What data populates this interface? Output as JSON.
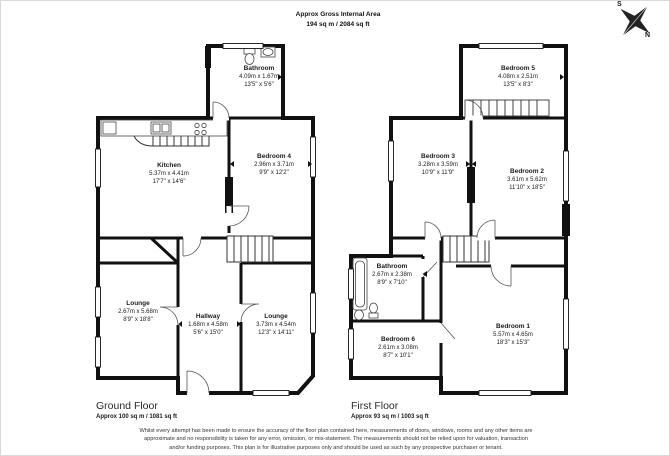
{
  "header": {
    "title": "Approx Gross Internal Area",
    "area": "194 sq m / 2084 sq ft"
  },
  "compass": {
    "north": "N",
    "south": "S"
  },
  "ground_floor": {
    "title": "Ground Floor",
    "area": "Approx 100 sq m / 1081 sq ft",
    "rooms": [
      {
        "name": "Bathroom",
        "metric": "4.09m x 1.67m",
        "imperial": "13'5\" x 5'6\""
      },
      {
        "name": "Kitchen",
        "metric": "5.37m x 4.41m",
        "imperial": "17'7\" x 14'6\""
      },
      {
        "name": "Bedroom 4",
        "metric": "2.96m x 3.71m",
        "imperial": "9'9\" x 12'2\""
      },
      {
        "name": "Lounge",
        "metric": "2.67m x 5.68m",
        "imperial": "8'9\" x 18'8\""
      },
      {
        "name": "Hallway",
        "metric": "1.68m x 4.58m",
        "imperial": "5'6\" x 15'0\""
      },
      {
        "name": "Lounge",
        "metric": "3.73m x 4.54m",
        "imperial": "12'3\" x 14'11\""
      }
    ]
  },
  "first_floor": {
    "title": "First Floor",
    "area": "Approx 93 sq m / 1003 sq ft",
    "rooms": [
      {
        "name": "Bedroom 5",
        "metric": "4.08m x 2.51m",
        "imperial": "13'5\" x 8'3\""
      },
      {
        "name": "Bedroom 3",
        "metric": "3.28m x 3.59m",
        "imperial": "10'9\" x 11'9\""
      },
      {
        "name": "Bedroom 2",
        "metric": "3.61m x 5.62m",
        "imperial": "11'10\" x 18'5\""
      },
      {
        "name": "Bathroom",
        "metric": "2.67m x 2.38m",
        "imperial": "8'9\" x 7'10\""
      },
      {
        "name": "Bedroom 6",
        "metric": "2.61m x 3.08m",
        "imperial": "8'7\" x 10'1\""
      },
      {
        "name": "Bedroom 1",
        "metric": "5.57m x 4.65m",
        "imperial": "18'3\" x 15'3\""
      }
    ]
  },
  "disclaimer": "Whilst every attempt has been made to ensure the accuracy of the floor plan contained here, measurements of doors, windows, rooms and any other items are approximate and no responsibility is taken for any error, omission, or mis-statement. The measurements should not be relied upon for valuation, transaction and/or funding purposes. This plan is for illustrative purposes only and should be used as such by any prospective purchaser or tenant."
}
